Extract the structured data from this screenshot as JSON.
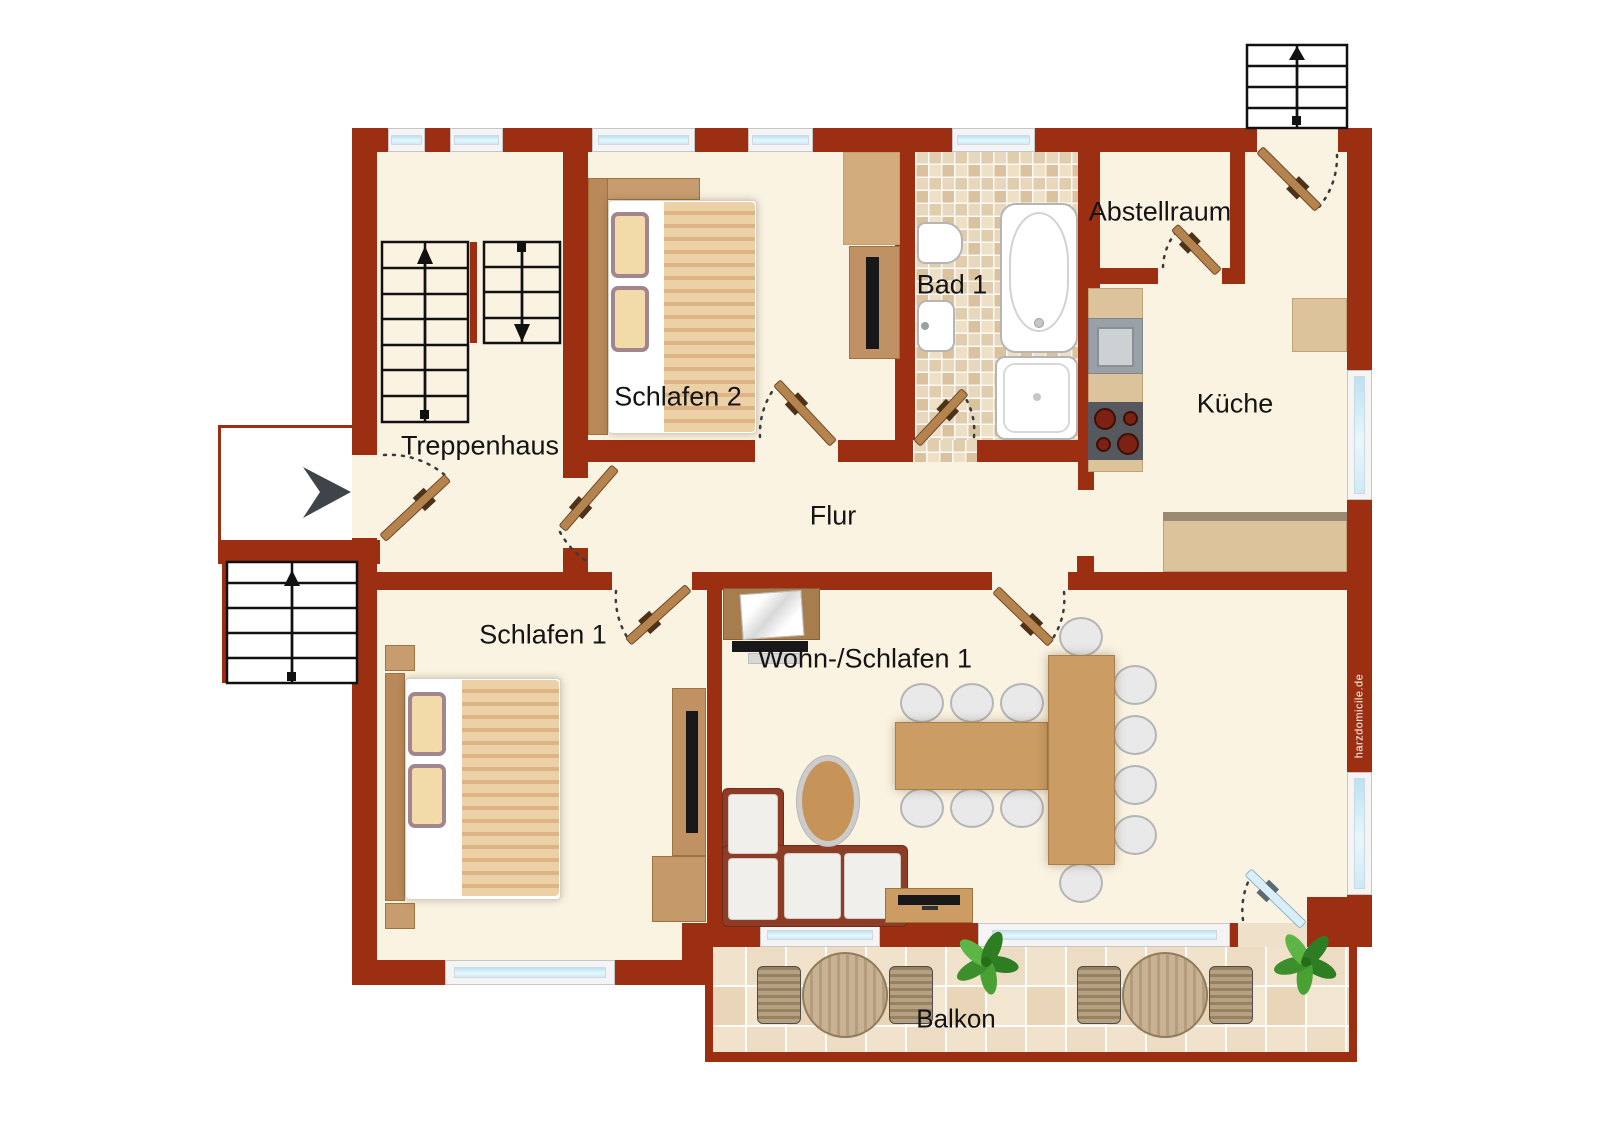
{
  "rooms": {
    "treppenhaus": {
      "label": "Treppenhaus"
    },
    "schlafen2": {
      "label": "Schlafen 2"
    },
    "bad1": {
      "label": "Bad 1"
    },
    "abstellraum": {
      "label": "Abstellraum"
    },
    "kueche": {
      "label": "Küche"
    },
    "flur": {
      "label": "Flur"
    },
    "schlafen1": {
      "label": "Schlafen 1"
    },
    "wohnschlafen1": {
      "label": "Wohn-/Schlafen 1"
    },
    "balkon": {
      "label": "Balkon"
    }
  },
  "watermark": "harzdomicile.de",
  "colors": {
    "wall": "#9c2e12",
    "floor": "#fbf3e2",
    "bath_tile": "#ead9bd",
    "balcony_tile": "#f0e1ca",
    "window_glass": "#cfeaf8",
    "wood": "#c09162",
    "door_leaf": "#b5834e",
    "sofa": "#8f3c26",
    "stair_outline": "#111111",
    "entrance_arrow": "#3f444a"
  },
  "icons": {
    "entrance_arrow": "▶",
    "stair_up_arrow": "↑",
    "stair_down_arrow": "↓"
  }
}
